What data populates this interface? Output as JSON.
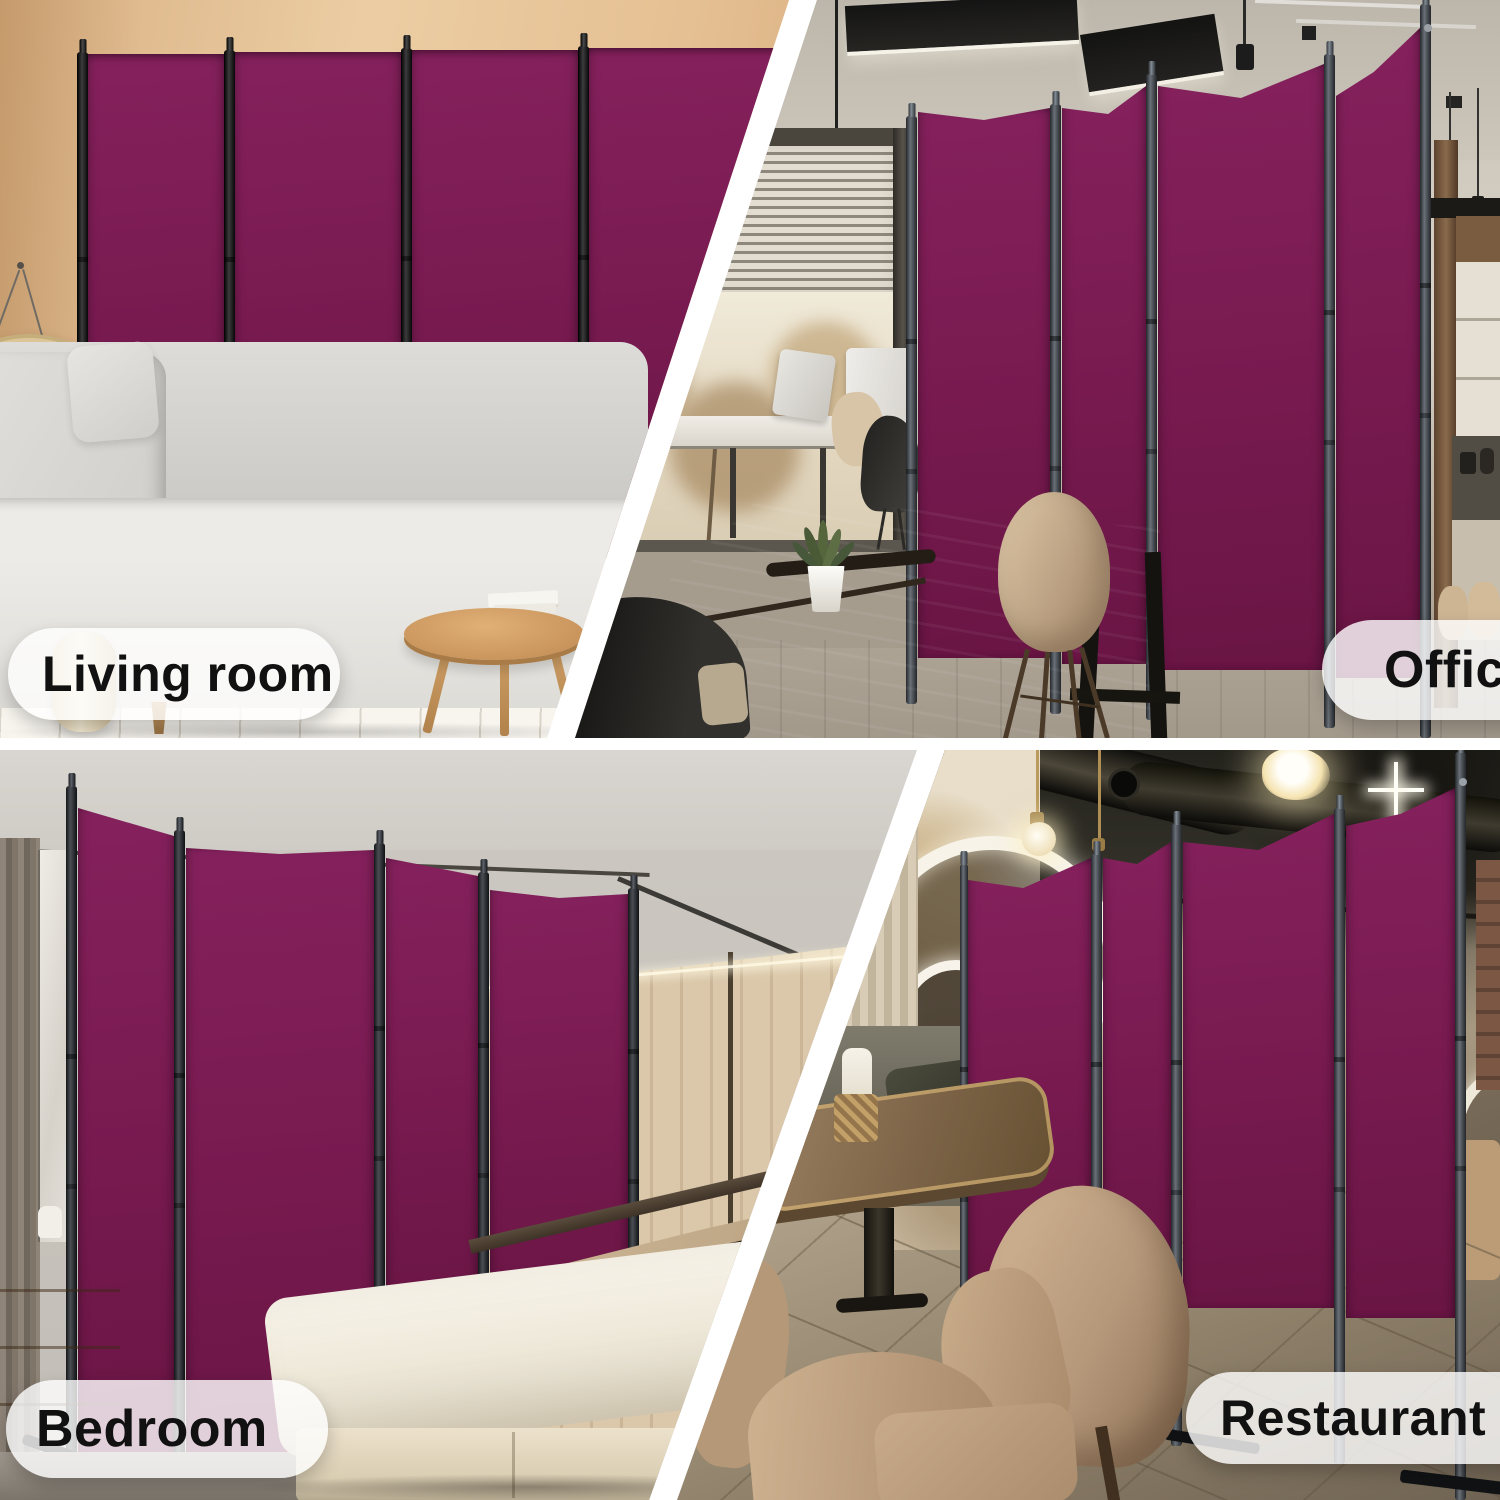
{
  "scenes": [
    {
      "id": "living-room",
      "label": "Living room"
    },
    {
      "id": "office",
      "label": "Office"
    },
    {
      "id": "bedroom",
      "label": "Bedroom"
    },
    {
      "id": "restaurant",
      "label": "Restaurant"
    }
  ],
  "clock": {
    "twelve": "12"
  },
  "colors": {
    "panel": "#7a1b52",
    "panelLight": "#85215d",
    "panelDark": "#691544",
    "labelBg": "rgba(255,255,255,0.8)",
    "labelText": "#111111"
  }
}
